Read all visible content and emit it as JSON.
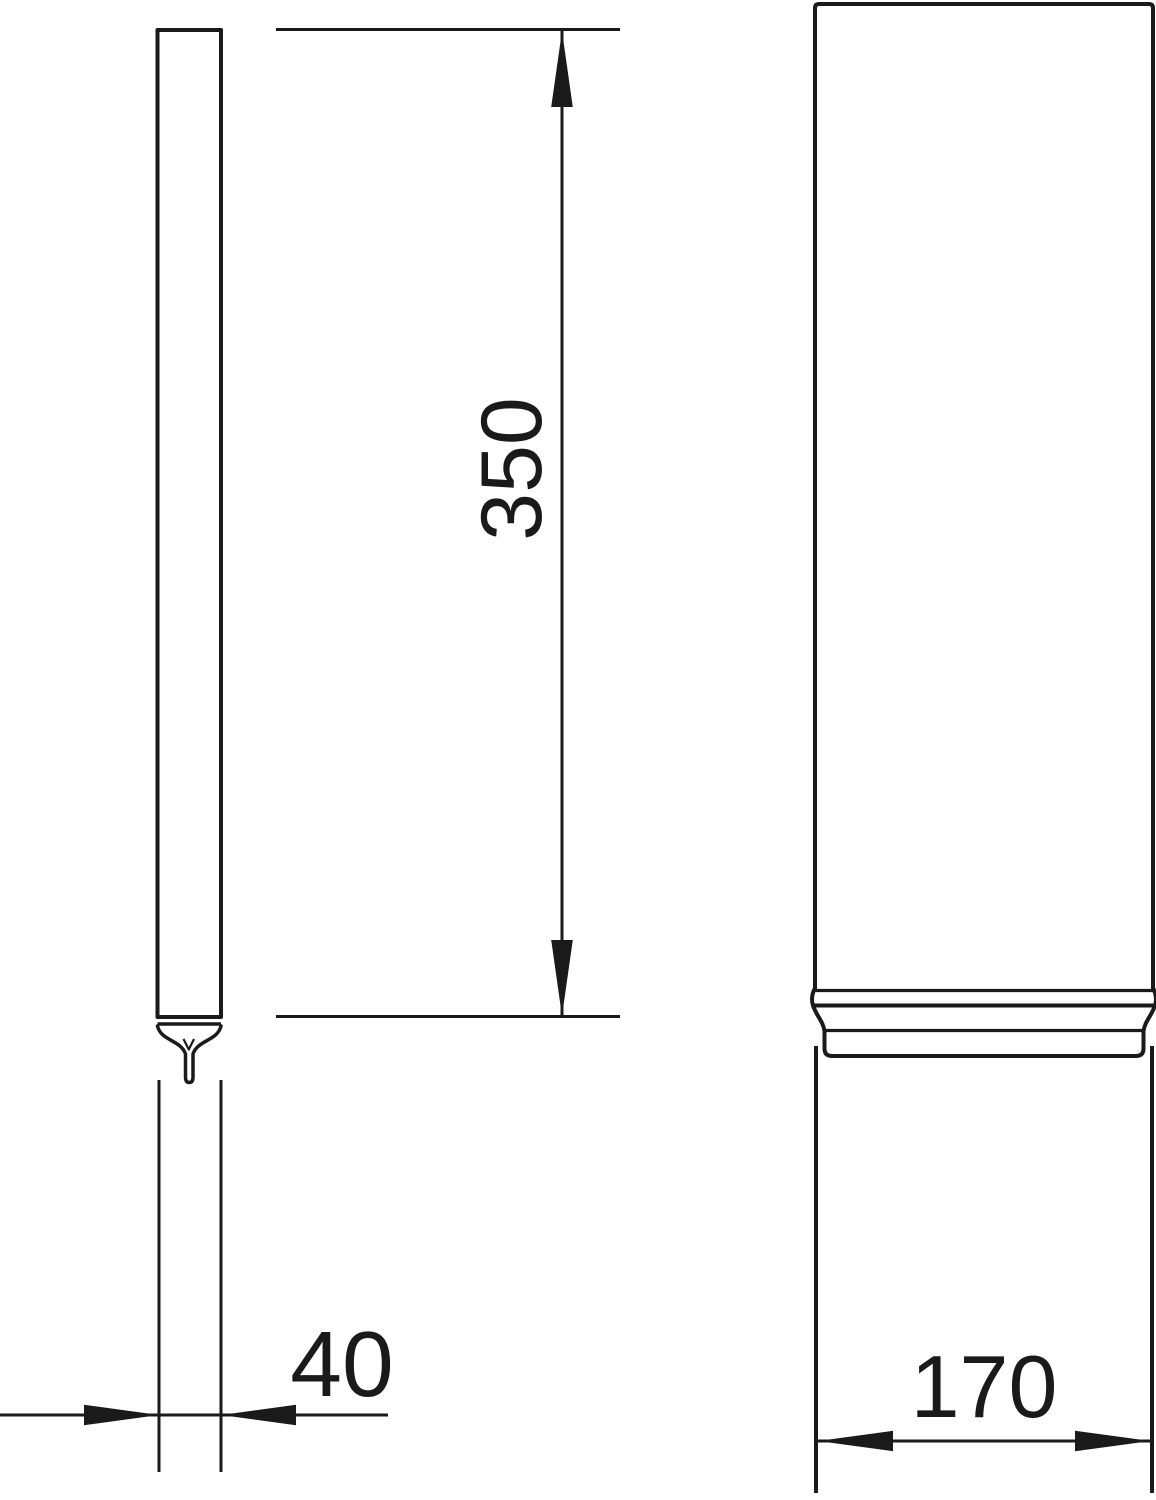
{
  "drawing": {
    "dimensions": {
      "length": "350",
      "small_diameter": "40",
      "large_diameter": "170"
    },
    "colors": {
      "line": "#1a1a1a",
      "background": "#ffffff"
    }
  }
}
